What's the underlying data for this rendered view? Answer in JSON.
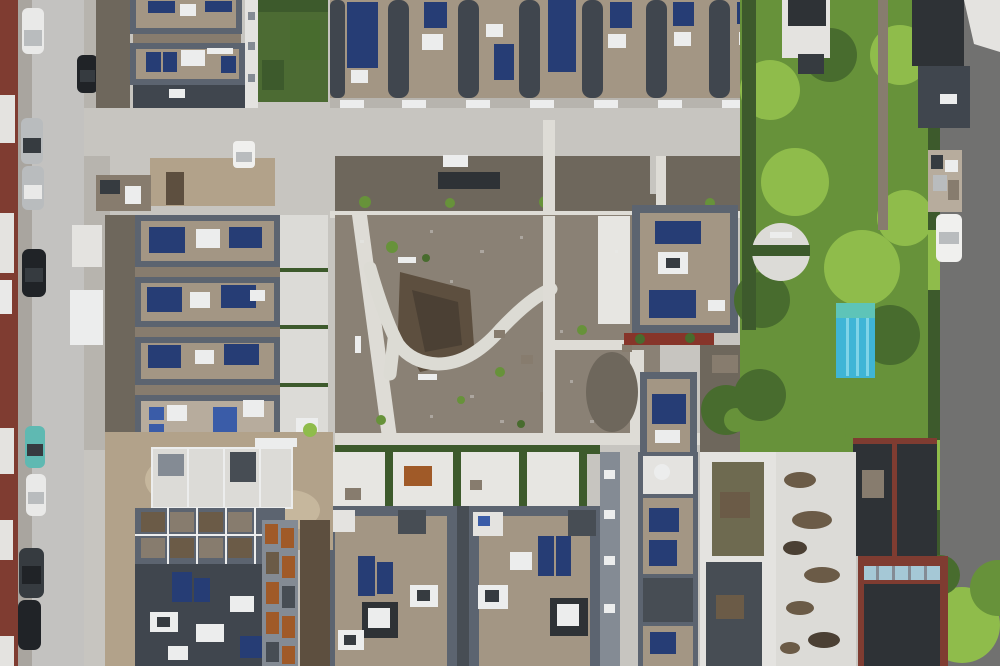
{
  "meta": {
    "type": "aerial-drone-photograph",
    "description": "Top-down aerial view of a newly built residential quarter: row houses with rooftop solar panels, a central unfinished courtyard with a winding white cobblestone path, a street with parked cars on the left, private gardens with trees, a small covered swimming pool and a dark asphalt alley on the right.",
    "width_px": 1000,
    "height_px": 666
  },
  "palette": {
    "pavement": "#c7c5c0",
    "pavement_dark": "#b7b4ae",
    "street": "#c3c2c0",
    "sidewalk": "#a9a59f",
    "asphalt": "#717170",
    "brick_red": "#7f3c31",
    "facade_white": "#e4e3e0",
    "roof_frame": "#5c6470",
    "roof_dark": "#40464e",
    "roof_charcoal": "#2e3236",
    "gravel": "#a39684",
    "gravel_light": "#b7ac9d",
    "gravel_dark": "#877c6e",
    "pv_blue": "#263d75",
    "pv_light": "#3a5ca8",
    "white_box": "#eceded",
    "white_roof": "#dcdbd7",
    "terrace_white": "#e7e6e2",
    "dirt_court": "#8a8175",
    "dirt_dark": "#6e675c",
    "soil_brown": "#5d4f3f",
    "mud_brown": "#4b4034",
    "construction_tan": "#b2a28a",
    "sand": "#c6b79d",
    "lawn_green": "#4c6b33",
    "hedge_green": "#3d5a2c",
    "tree_green": "#67923a",
    "tree_bright": "#8fbc4b",
    "tree_dark": "#486c2e",
    "pool_cyan": "#3fb5d6",
    "pool_lane": "#7fd4e8",
    "pool_cover": "#5ec4b8",
    "cobble_white": "#dcdbd4",
    "path_white": "#dedcd6",
    "wood_orange": "#a05a28",
    "flower_red": "#87352a",
    "car_white": "#e9e9e8",
    "car_silver": "#b9bcbe",
    "car_black": "#202327",
    "car_teal": "#5fb9b2",
    "car_dark": "#363b40",
    "van_white": "#f0f0ee",
    "glass_dark": "#474d54",
    "skylight_blue": "#a5c8d6",
    "stain_brown": "#6b5b47",
    "moss_green": "#6e6a50",
    "wall_gray": "#848b94"
  },
  "scene": {
    "streets": [
      "left residential street with two parking lanes",
      "dark asphalt alley on the right edge"
    ],
    "parked_cars": [
      {
        "name": "car-white-top-left",
        "color_key": "car_white"
      },
      {
        "name": "car-black-second-lane",
        "color_key": "car_black"
      },
      {
        "name": "car-silver-1",
        "color_key": "car_silver"
      },
      {
        "name": "car-silver-2",
        "color_key": "car_silver"
      },
      {
        "name": "car-black-1",
        "color_key": "car_black"
      },
      {
        "name": "car-teal",
        "color_key": "car_teal"
      },
      {
        "name": "car-white-2",
        "color_key": "car_white"
      },
      {
        "name": "car-dark-suv",
        "color_key": "car_dark"
      },
      {
        "name": "car-black-2",
        "color_key": "car_black"
      },
      {
        "name": "white-van-alley",
        "color_key": "van_white"
      },
      {
        "name": "white-pickup-courtyard",
        "color_key": "van_white"
      }
    ],
    "landmarks": [
      "seven parallel row-house roofs with gravel strips and solar arrays (top centre)",
      "four horizontal apartment blocks with solar panels (middle left)",
      "central courtyard under landscaping with Y-shaped white cobblestone path",
      "square building with rooftop solar panels (centre right)",
      "covered turquoise swimming pool in garden (right)",
      "round grey water tank in garden (right)",
      "two large gravel-roof apartment buildings with penthouses (bottom centre)",
      "building under construction with white structural frame and orange wood facade (bottom left)",
      "large white flat roof with brown weathering stains (bottom right)"
    ],
    "vegetation": "mature trees, trimmed hedges and young shrubs in courtyard and side gardens"
  }
}
